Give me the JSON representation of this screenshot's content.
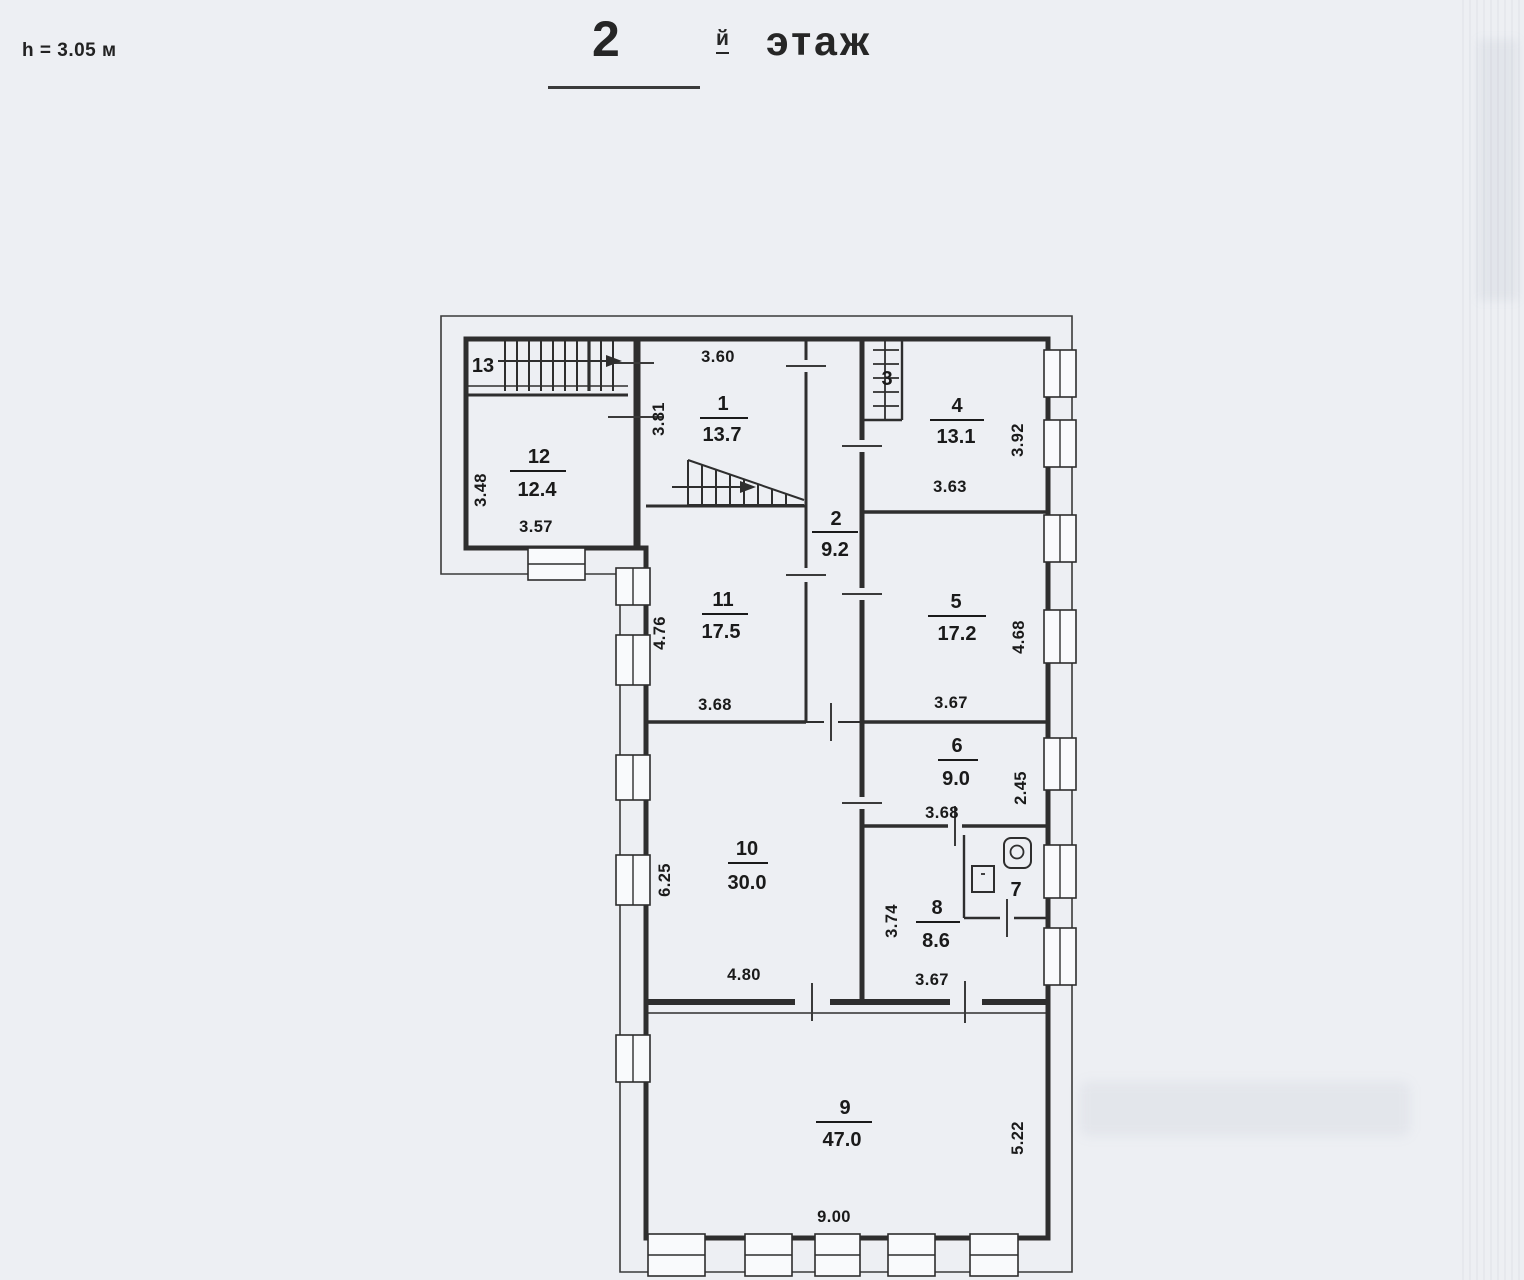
{
  "header": {
    "ceiling_height": "h = 3.05 м",
    "floor_number": "2",
    "floor_suffix": "й",
    "floor_word": "этаж"
  },
  "rooms": {
    "r1": {
      "number": "1",
      "area": "13.7"
    },
    "r2": {
      "number": "2",
      "area": "9.2"
    },
    "r3": {
      "number": "3"
    },
    "r4": {
      "number": "4",
      "area": "13.1"
    },
    "r5": {
      "number": "5",
      "area": "17.2"
    },
    "r6": {
      "number": "6",
      "area": "9.0"
    },
    "r7": {
      "number": "7"
    },
    "r8": {
      "number": "8",
      "area": "8.6"
    },
    "r9": {
      "number": "9",
      "area": "47.0"
    },
    "r10": {
      "number": "10",
      "area": "30.0"
    },
    "r11": {
      "number": "11",
      "area": "17.5"
    },
    "r12": {
      "number": "12",
      "area": "12.4"
    },
    "r13": {
      "number": "13"
    }
  },
  "dimensions": {
    "r1_top": "3.60",
    "r1_left": "3.81",
    "r4_bottom": "3.63",
    "r4_right": "3.92",
    "r5_bottom": "3.67",
    "r5_right": "4.68",
    "r6_bottom": "3.68",
    "r6_right": "2.45",
    "r8_left": "3.74",
    "r8_bottom": "3.67",
    "r9_bottom": "9.00",
    "r9_right": "5.22",
    "r10_left": "6.25",
    "r10_bottom": "4.80",
    "r11_left": "4.76",
    "r11_bottom": "3.68",
    "r12_left": "3.48",
    "r12_bottom": "3.57"
  }
}
